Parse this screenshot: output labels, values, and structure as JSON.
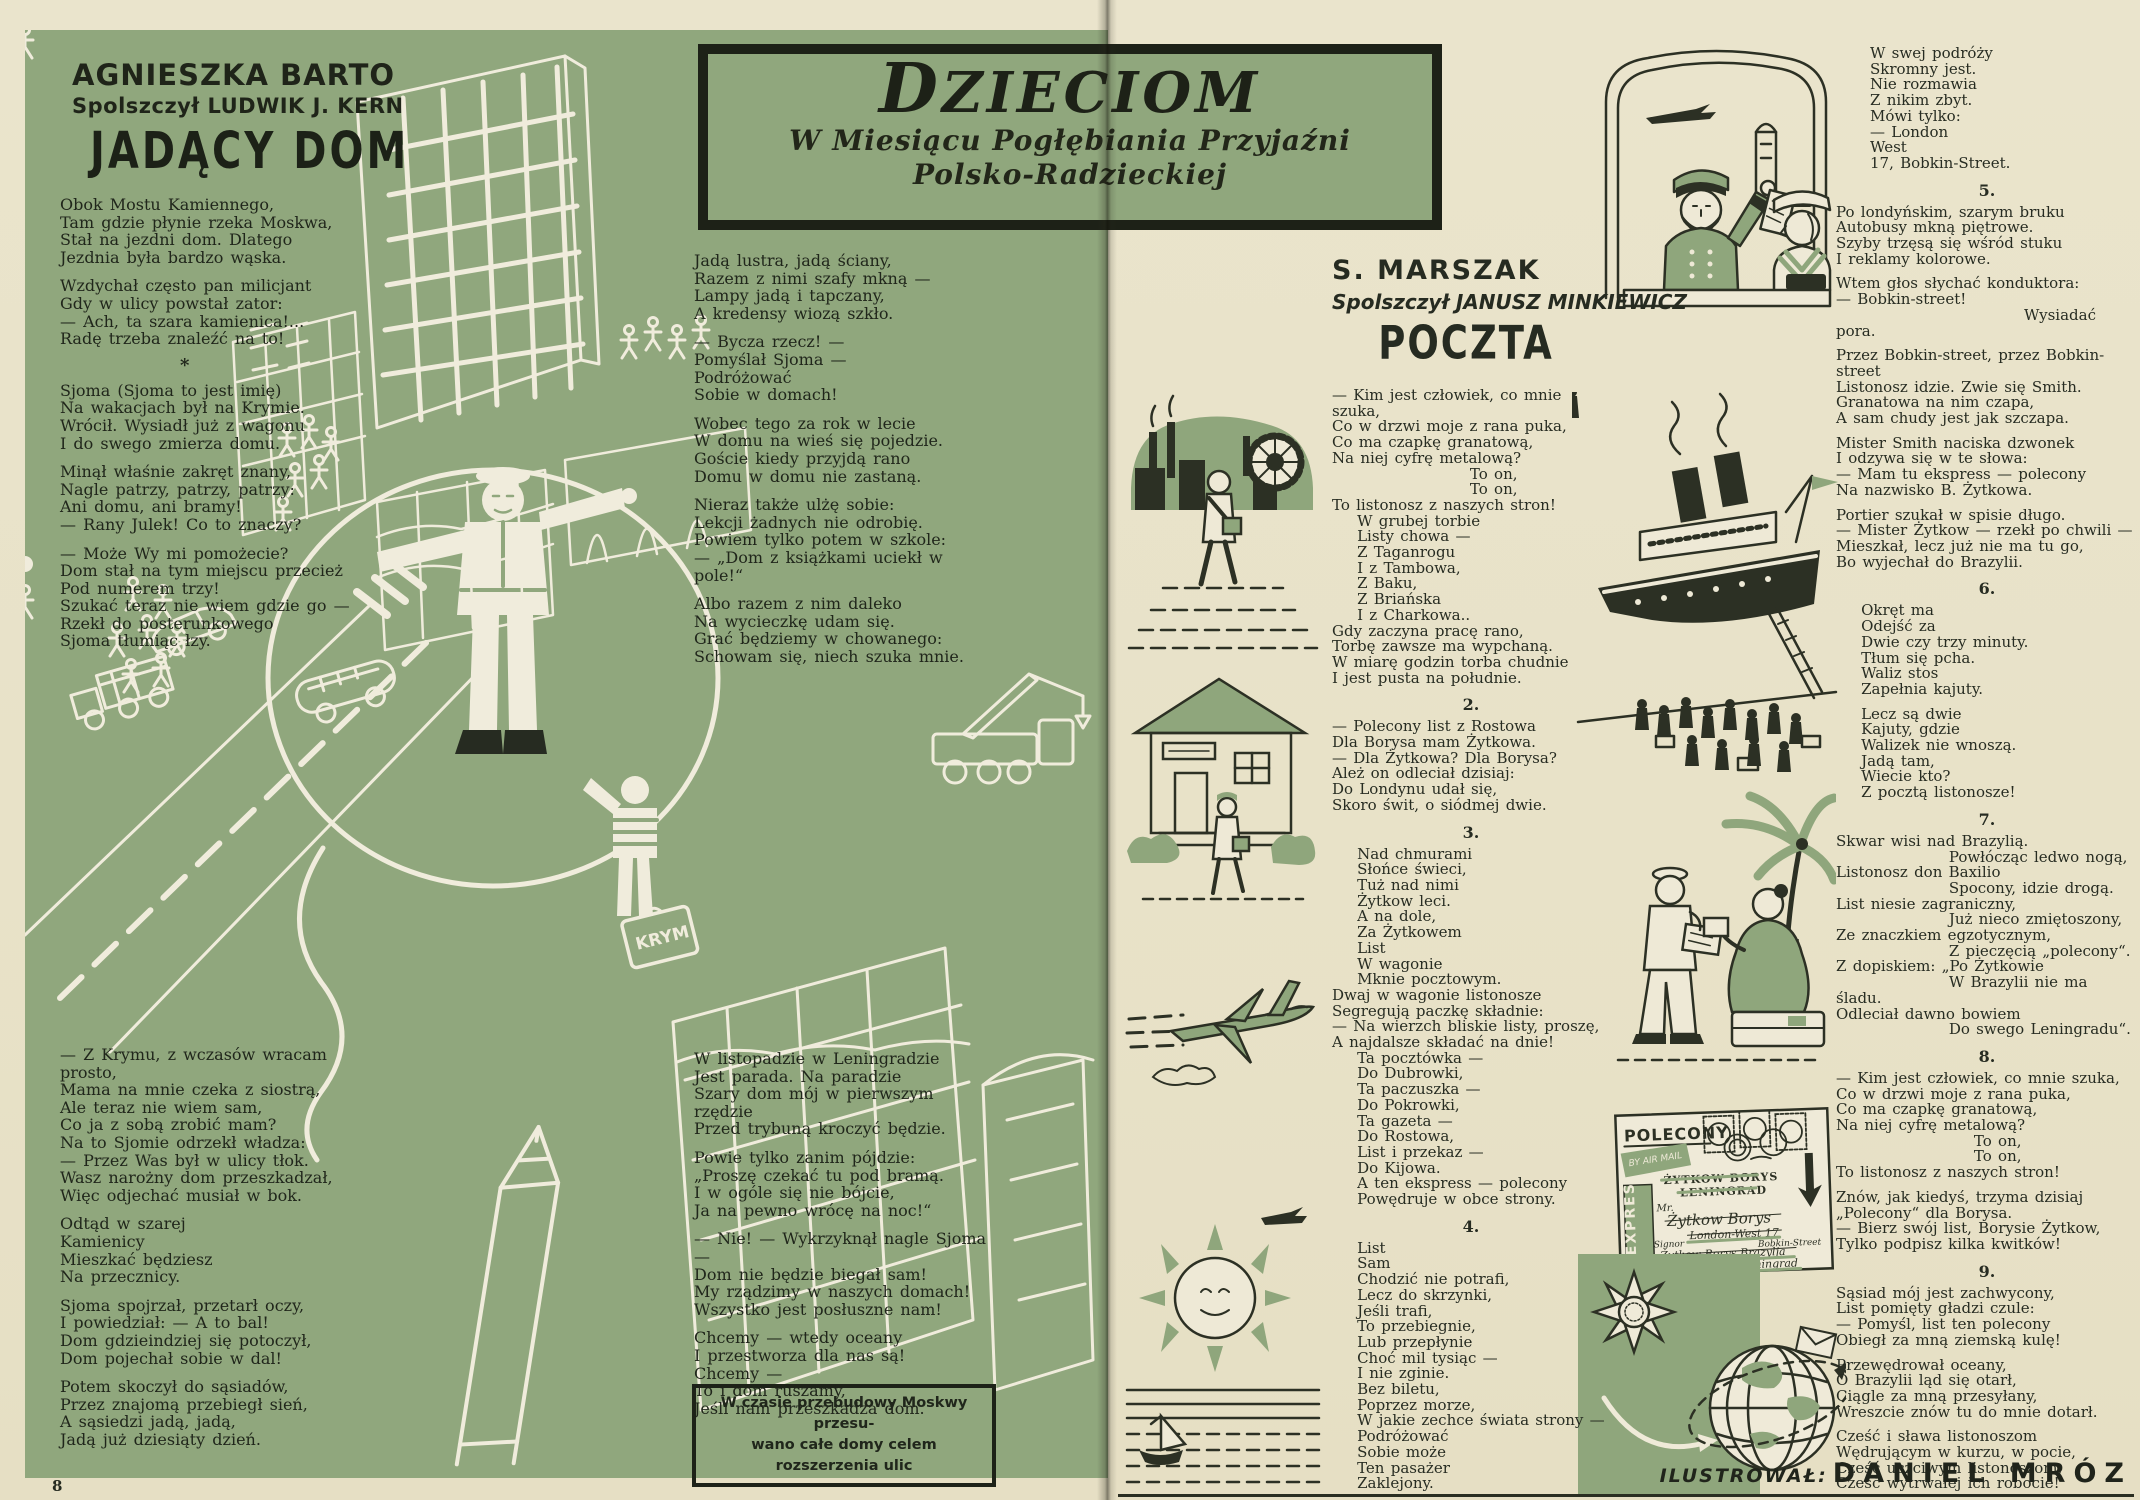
{
  "page_number": "8",
  "colors": {
    "paper": "#e8e2c8",
    "panel_green": "#90a77d",
    "ink": "#262b21",
    "art_cream": "#f0ecdc"
  },
  "header_box": {
    "title": "DZIECIOM",
    "subtitle_line1": "W Miesiącu Pogłębiania Przyjaźni",
    "subtitle_line2": "Polsko-Radzieckiej"
  },
  "left_page": {
    "author": "AGNIESZKA BARTO",
    "translator": "Spolszczył LUDWIK J. KERN",
    "title": "JADĄCY DOM",
    "separator": "*",
    "suitcase_label": "KRYM",
    "col1_top": [
      [
        "Obok Mostu Kamiennego,",
        "Tam gdzie płynie rzeka Moskwa,",
        "Stał na jezdni dom. Dlatego",
        "Jezdnia była bardzo wąska."
      ],
      [
        "Wzdychał często pan milicjant",
        "Gdy w ulicy powstał zator:",
        "— Ach, ta szara kamienica!...",
        "Radę trzeba znaleźć na to!"
      ],
      [
        "Sjoma (Sjoma to jest imię)",
        "Na wakacjach był na Krymie.",
        "Wrócił. Wysiadł już z wagonu",
        "I do swego zmierza domu."
      ],
      [
        "Minął właśnie zakręt znany,",
        "Nagle patrzy, patrzy, patrzy:",
        "Ani domu, ani bramy!",
        "— Rany Julek! Co to znaczy?"
      ],
      [
        "— Może Wy mi pomożecie?",
        "Dom stał na tym miejscu przecież",
        "Pod numerem trzy!",
        "Szukać teraz nie wiem gdzie go —",
        "Rzekł do posterunkowego",
        "Sjoma tłumiąc łzy."
      ]
    ],
    "col1_bottom": [
      [
        "— Z Krymu, z wczasów wracam prosto,",
        "Mama na mnie czeka z siostrą,",
        "Ale teraz nie wiem sam,",
        "Co ja z sobą zrobić mam?",
        "Na to Sjomie odrzekł władza:",
        "— Przez Was był w ulicy tłok.",
        "Wasz narożny dom przeszkadzał,",
        "Więc odjechać musiał w bok."
      ],
      [
        "Odtąd w szarej",
        "Kamienicy",
        "Mieszkać będziesz",
        "Na przecznicy."
      ],
      [
        "Sjoma spojrzał, przetarł oczy,",
        "I powiedział: — A to bal!",
        "Dom gdzieindziej się potoczył,",
        "Dom pojechał sobie w dal!"
      ],
      [
        "Potem skoczył do sąsiadów,",
        "Przez znajomą przebiegł sień,",
        "A sąsiedzi jadą, jadą,",
        "Jadą już dziesiąty dzień."
      ]
    ],
    "col2_top": [
      [
        "Jadą lustra, jadą ściany,",
        "Razem z nimi szafy mkną —",
        "Lampy jadą i tapczany,",
        "A kredensy wiozą szkło."
      ],
      [
        "— Bycza rzecz! —",
        "Pomyślał Sjoma —",
        "Podróżować",
        "Sobie w domach!"
      ],
      [
        "Wobec tego za rok w lecie",
        "W domu na wieś się pojedzie.",
        "Goście kiedy przyjdą rano",
        "Domu w domu nie zastaną."
      ],
      [
        "Nieraz także ulżę sobie:",
        "Lekcji żadnych nie odrobię.",
        "Powiem tylko potem w szkole:",
        "— „Dom z książkami uciekł w pole!“"
      ],
      [
        "Albo razem z nim daleko",
        "Na wycieczkę udam się.",
        "Grać będziemy w chowanego:",
        "Schowam się, niech szuka mnie."
      ]
    ],
    "col2_bottom": [
      [
        "W listopadzie w Leningradzie",
        "Jest parada. Na paradzie",
        "Szary dom mój w pierwszym rzędzie",
        "Przed trybuną kroczyć będzie."
      ],
      [
        "Powie tylko zanim pójdzie:",
        "„Proszę czekać tu pod bramą.",
        "I w ogóle się nie bójcie,",
        "Ja na pewno wrócę na noc!“"
      ],
      [
        "— Nie! — Wykrzyknął nagle Sjoma —",
        "Dom nie będzie biegał sam!",
        "My rządzimy w naszych domach!",
        "Wszystko jest posłuszne nam!"
      ],
      [
        "Chcemy — wtedy oceany",
        "I przestworza dla nas są!",
        "Chcemy —",
        "To i dom ruszamy,",
        "Jeśli nam przeszkadza dom."
      ]
    ],
    "note_box": [
      "W czasie przebudowy Moskwy przesu-",
      "wano całe domy celem rozszerzenia ulic"
    ]
  },
  "right_page": {
    "author": "S. MARSZAK",
    "translator": "Spolszczył JANUSZ MINKIEWICZ",
    "title": "POCZTA",
    "col1": [
      {
        "lines": [
          "— Kim jest człowiek, co mnie szuka,",
          "Co w drzwi moje z rana puka,",
          "Co ma czapkę granatową,",
          "Na niej cyfrę metalową?",
          "                      To on,",
          "                      To on,",
          "To listonosz z naszych stron!",
          "    W grubej torbie",
          "    Listy chowa —",
          "    Z Taganrogu",
          "    I z Tambowa,",
          "    Z Baku,",
          "    Z Briańska",
          "    I z Charkowa..",
          "Gdy zaczyna pracę rano,",
          "Torbę zawsze ma wypchaną.",
          "W miarę godzin torba chudnie",
          "I jest pusta na południe."
        ]
      },
      {
        "num": "2.",
        "lines": [
          "— Polecony list z Rostowa",
          "Dla Borysa mam Żytkowa.",
          "— Dla Żytkowa? Dla Borysa?",
          "Ależ on odleciał dzisiaj:",
          "Do Londynu udał się,",
          "Skoro świt, o siódmej dwie."
        ]
      },
      {
        "num": "3.",
        "lines": [
          "    Nad chmurami",
          "    Słońce świeci,",
          "    Tuż nad nimi",
          "    Żytkow leci.",
          "    A na dole,",
          "    Za Żytkowem",
          "    List",
          "    W wagonie",
          "    Mknie pocztowym.",
          "Dwaj w wagonie listonosze",
          "Segregują paczkę składnie:",
          "— Na wierzch bliskie listy, proszę,",
          "A najdalsze składać na dnie!",
          "    Ta pocztówka —",
          "    Do Dubrowki,",
          "    Ta paczuszka —",
          "    Do Pokrowki,",
          "    Ta gazeta —",
          "    Do Rostowa,",
          "    List i przekaz —",
          "    Do Kijowa.",
          "    A ten ekspress — polecony",
          "    Powędruje w obce strony."
        ]
      },
      {
        "num": "4.",
        "lines": [
          "    List",
          "    Sam",
          "    Chodzić nie potrafi,",
          "    Lecz do skrzynki,",
          "    Jeśli trafi,",
          "    To przebiegnie,",
          "    Lub przepłynie",
          "    Choć mil tysiąc —",
          "    I nie zginie.",
          "    Bez biletu,",
          "    Poprzez morze,",
          "    W jakie zechce świata strony —",
          "    Podróżować",
          "    Sobie może",
          "    Ten pasażer",
          "    Zaklejony."
        ]
      }
    ],
    "col2": [
      {
        "lines": [
          "W swej podróży",
          "Skromny jest.",
          "Nie rozmawia",
          "Z nikim zbyt.",
          "Mówi tylko:",
          "— London",
          "West",
          "17, Bobkin-Street."
        ]
      },
      {
        "num": "5.",
        "lines": [
          "Po londyńskim, szarym bruku",
          "Autobusy mkną piętrowe.",
          "Szyby trzęsą się wśród stuku",
          "I reklamy kolorowe."
        ]
      },
      {
        "lines": [
          "Wtem głos słychać konduktora:",
          "— Bobkin-street!",
          "                              Wysiadać pora."
        ]
      },
      {
        "lines": [
          "Przez Bobkin-street, przez Bobkin-street",
          "Listonosz idzie. Zwie się Smith.",
          "Granatowa na nim czapa,",
          "A sam chudy jest jak szczapa."
        ]
      },
      {
        "lines": [
          "Mister Smith naciska dzwonek",
          "I odzywa się w te słowa:",
          "— Mam tu ekspress — polecony",
          "Na nazwisko B. Żytkowa."
        ]
      },
      {
        "lines": [
          "Portier szukał w spisie długo.",
          "— Mister Żytkow — rzekł po chwili —",
          "Mieszkał, lecz już nie ma tu go,",
          "Bo wyjechał do Brazylii."
        ]
      },
      {
        "num": "6.",
        "lines": [
          "    Okręt ma",
          "    Odejść za",
          "    Dwie czy trzy minuty.",
          "    Tłum się pcha.",
          "    Waliz stos",
          "    Zapełnia kajuty."
        ]
      },
      {
        "lines": [
          "    Lecz są dwie",
          "    Kajuty, gdzie",
          "    Walizek nie wnoszą.",
          "    Jadą tam,",
          "    Wiecie kto?",
          "    Z pocztą listonosze!"
        ]
      },
      {
        "num": "7.",
        "lines": [
          "Skwar wisi nad Brazylią.",
          "                  Powłócząc ledwo nogą,",
          "Listonosz don Baxilio",
          "                  Spocony, idzie drogą.",
          "List niesie zagraniczny,",
          "                  Już nieco zmiętoszony,",
          "Ze znaczkiem egzotycznym,",
          "                  Z pieczęcią „polecony“.",
          "Z dopiskiem: „Po Żytkowie",
          "                  W Brazylii nie ma śladu.",
          "Odleciał dawno bowiem",
          "                  Do swego Leningradu“."
        ]
      },
      {
        "num": "8.",
        "lines": [
          "— Kim jest człowiek, co mnie szuka,",
          "Co w drzwi moje z rana puka,",
          "Co ma czapkę granatową,",
          "Na niej cyfrę metalową?",
          "                      To on,",
          "                      To on,",
          "To listonosz z naszych stron!"
        ]
      },
      {
        "lines": [
          "Znów, jak kiedyś, trzyma dzisiaj",
          "„Polecony“ dla Borysa.",
          "— Bierz swój list, Borysie Żytkow,",
          "Tylko podpisz kilka kwitków!"
        ]
      },
      {
        "num": "9.",
        "lines": [
          "Sąsiad mój jest zachwycony,",
          "List pomięty gładzi czule:",
          "— Pomyśl, list ten polecony",
          "Obiegł za mną ziemską kulę!"
        ]
      },
      {
        "lines": [
          "Przewędrował oceany,",
          "O Brazylii ląd się otarł,",
          "Ciągle za mną przesyłany,",
          "Wreszcie znów tu do mnie dotarł."
        ]
      },
      {
        "lines": [
          "Cześć i sława listonoszom",
          "Wędrującym w kurzu, w pocie,",
          "Cześć uczciwym listonoszom,",
          "Cześć wytrwałej ich robocie!"
        ]
      }
    ],
    "credit_label": "ILUSTROWAŁ:",
    "credit_name": "DANIEL MRÓZ"
  },
  "envelope": {
    "polecony": "POLECONY",
    "expres": "EXPRES",
    "air_mail": "BY AIR MAIL",
    "addr1a": "ŻYTKOW BORYS",
    "addr1b": "LENINGRAD",
    "addr2a": "Mr.",
    "addr2b": "Żytkow Borys",
    "addr2c": "London-West 17",
    "addr2d": "Bobkin-Street",
    "addr3a": "Signor",
    "addr3b": "Żytkow Borys",
    "addr3c": "Brazylja",
    "addr4a": "Żytkow Borys",
    "addr4b": "Leningrad"
  }
}
